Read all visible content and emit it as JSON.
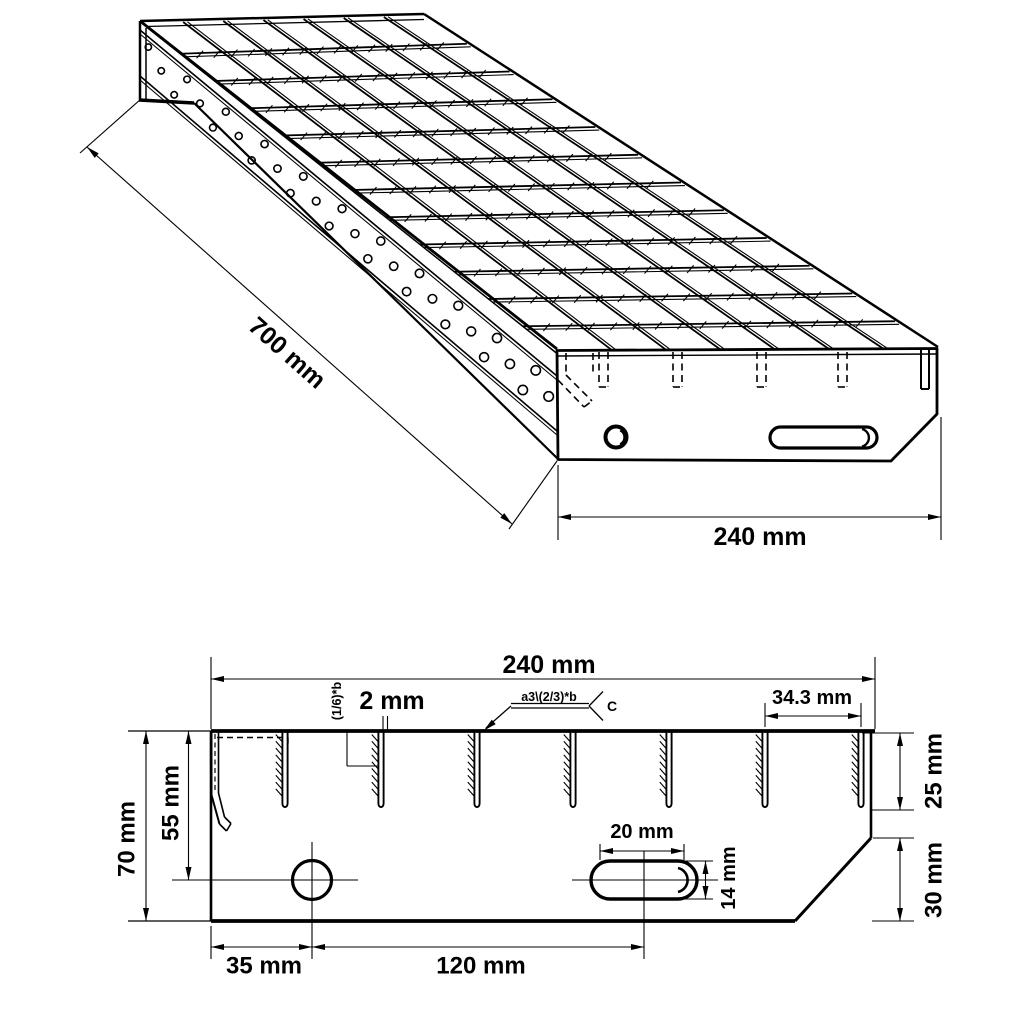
{
  "drawing": {
    "background": "#ffffff",
    "line_color": "#000000"
  },
  "isometric_view": {
    "length_dim": "700 mm",
    "width_dim": "240 mm"
  },
  "section_view": {
    "width_dim": "240 mm",
    "bar_spacing_dim": "34.3 mm",
    "bar_thickness_dim": "2 mm",
    "nosing_note": "(1/6)*b",
    "weld_symbol_text": "a3\\(2/3)*b",
    "weld_tail_text": "C",
    "bar_height_dim": "25 mm",
    "chamfer_height_dim": "30 mm",
    "total_height_dim": "70 mm",
    "hole_depth_dim": "55 mm",
    "hole_offset_dim": "35 mm",
    "slot_offset_dim": "120 mm",
    "slot_length_dim": "20 mm",
    "slot_height_dim": "14 mm"
  }
}
